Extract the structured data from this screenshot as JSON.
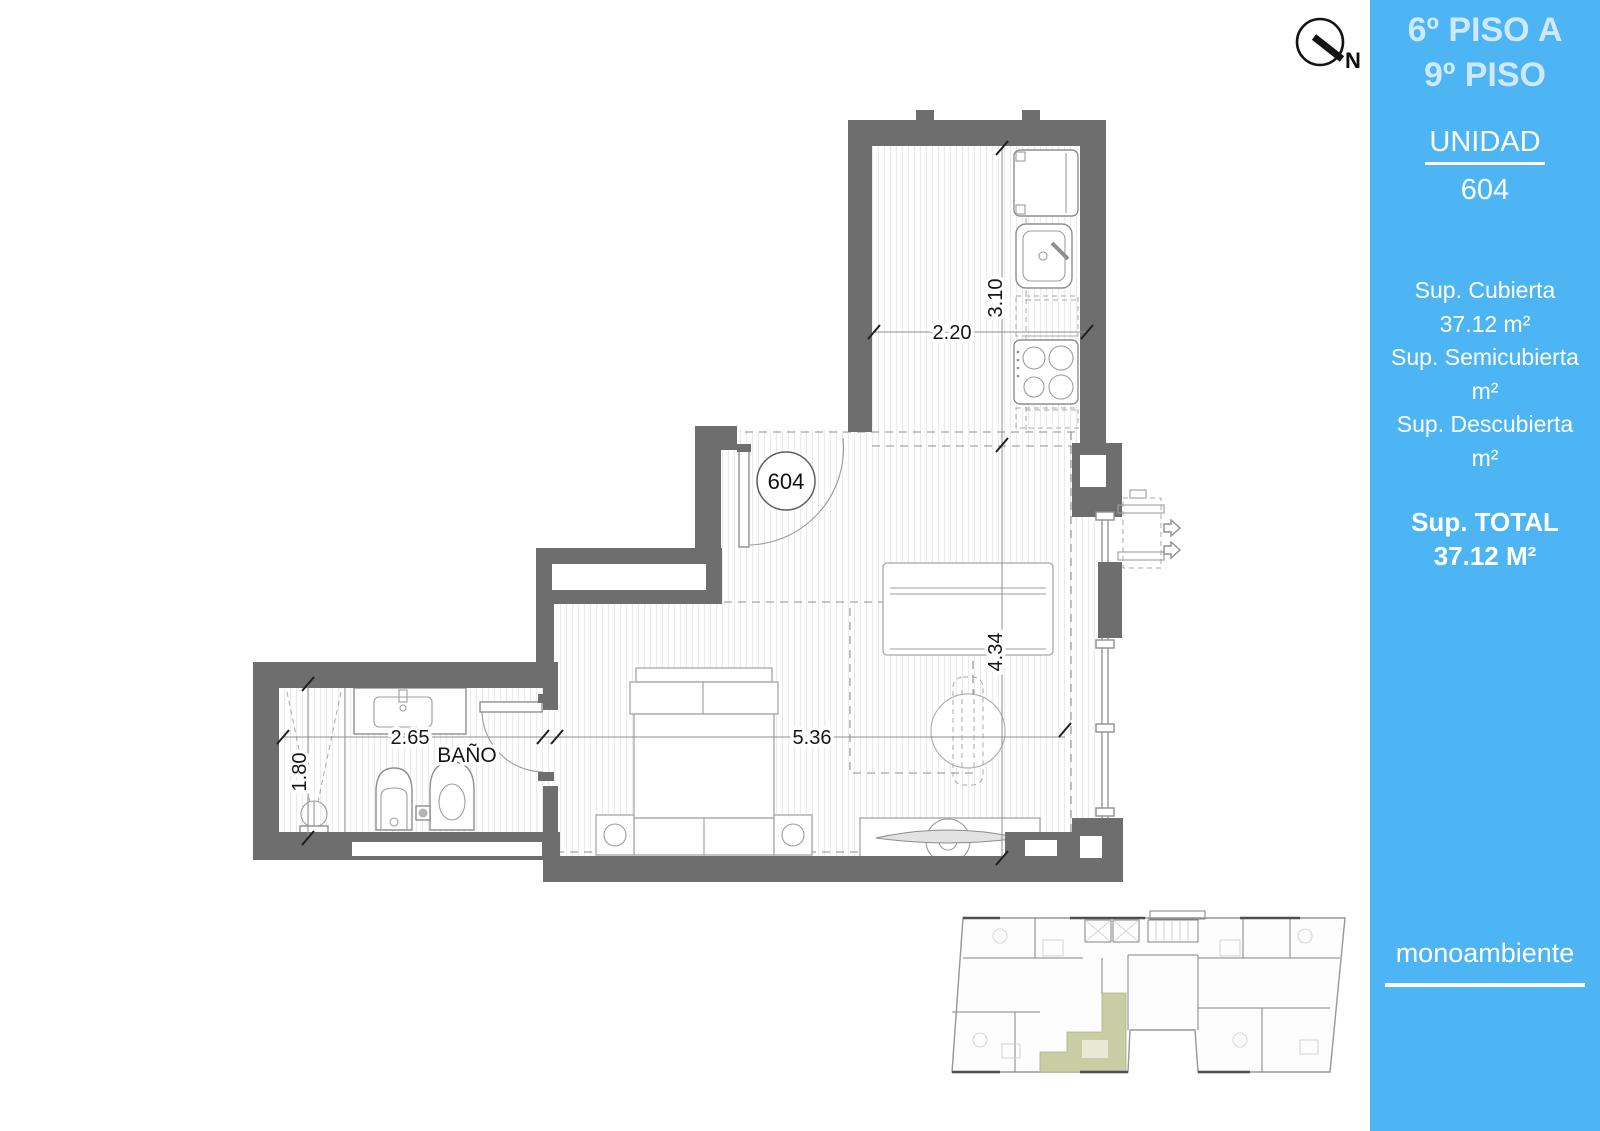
{
  "compass": {
    "label": "N"
  },
  "sidebar": {
    "floor_range": [
      "6º PISO A",
      "9º PISO"
    ],
    "unit_label": "UNIDAD",
    "unit_number": "604",
    "areas": [
      {
        "label": "Sup. Cubierta",
        "value": "37.12 m²"
      },
      {
        "label": "Sup. Semicubierta",
        "value": "m²"
      },
      {
        "label": "Sup. Descubierta",
        "value": "m²"
      }
    ],
    "total_label": "Sup. TOTAL",
    "total_value": "37.12 M²",
    "type_label": "monoambiente",
    "colors": {
      "background": "#4db5f3",
      "heading": "#cde9fb",
      "text": "#ffffff"
    }
  },
  "floorplan": {
    "unit_badge": "604",
    "rooms": [
      {
        "name": "BAÑO"
      }
    ],
    "dimensions": {
      "kitchen_width": "2.20",
      "kitchen_depth": "3.10",
      "living_width": "5.36",
      "living_depth": "4.34",
      "bath_width": "2.65",
      "bath_depth": "1.80"
    },
    "colors": {
      "wall": "#6e6e6e",
      "highlight": "#c9cda4"
    }
  }
}
